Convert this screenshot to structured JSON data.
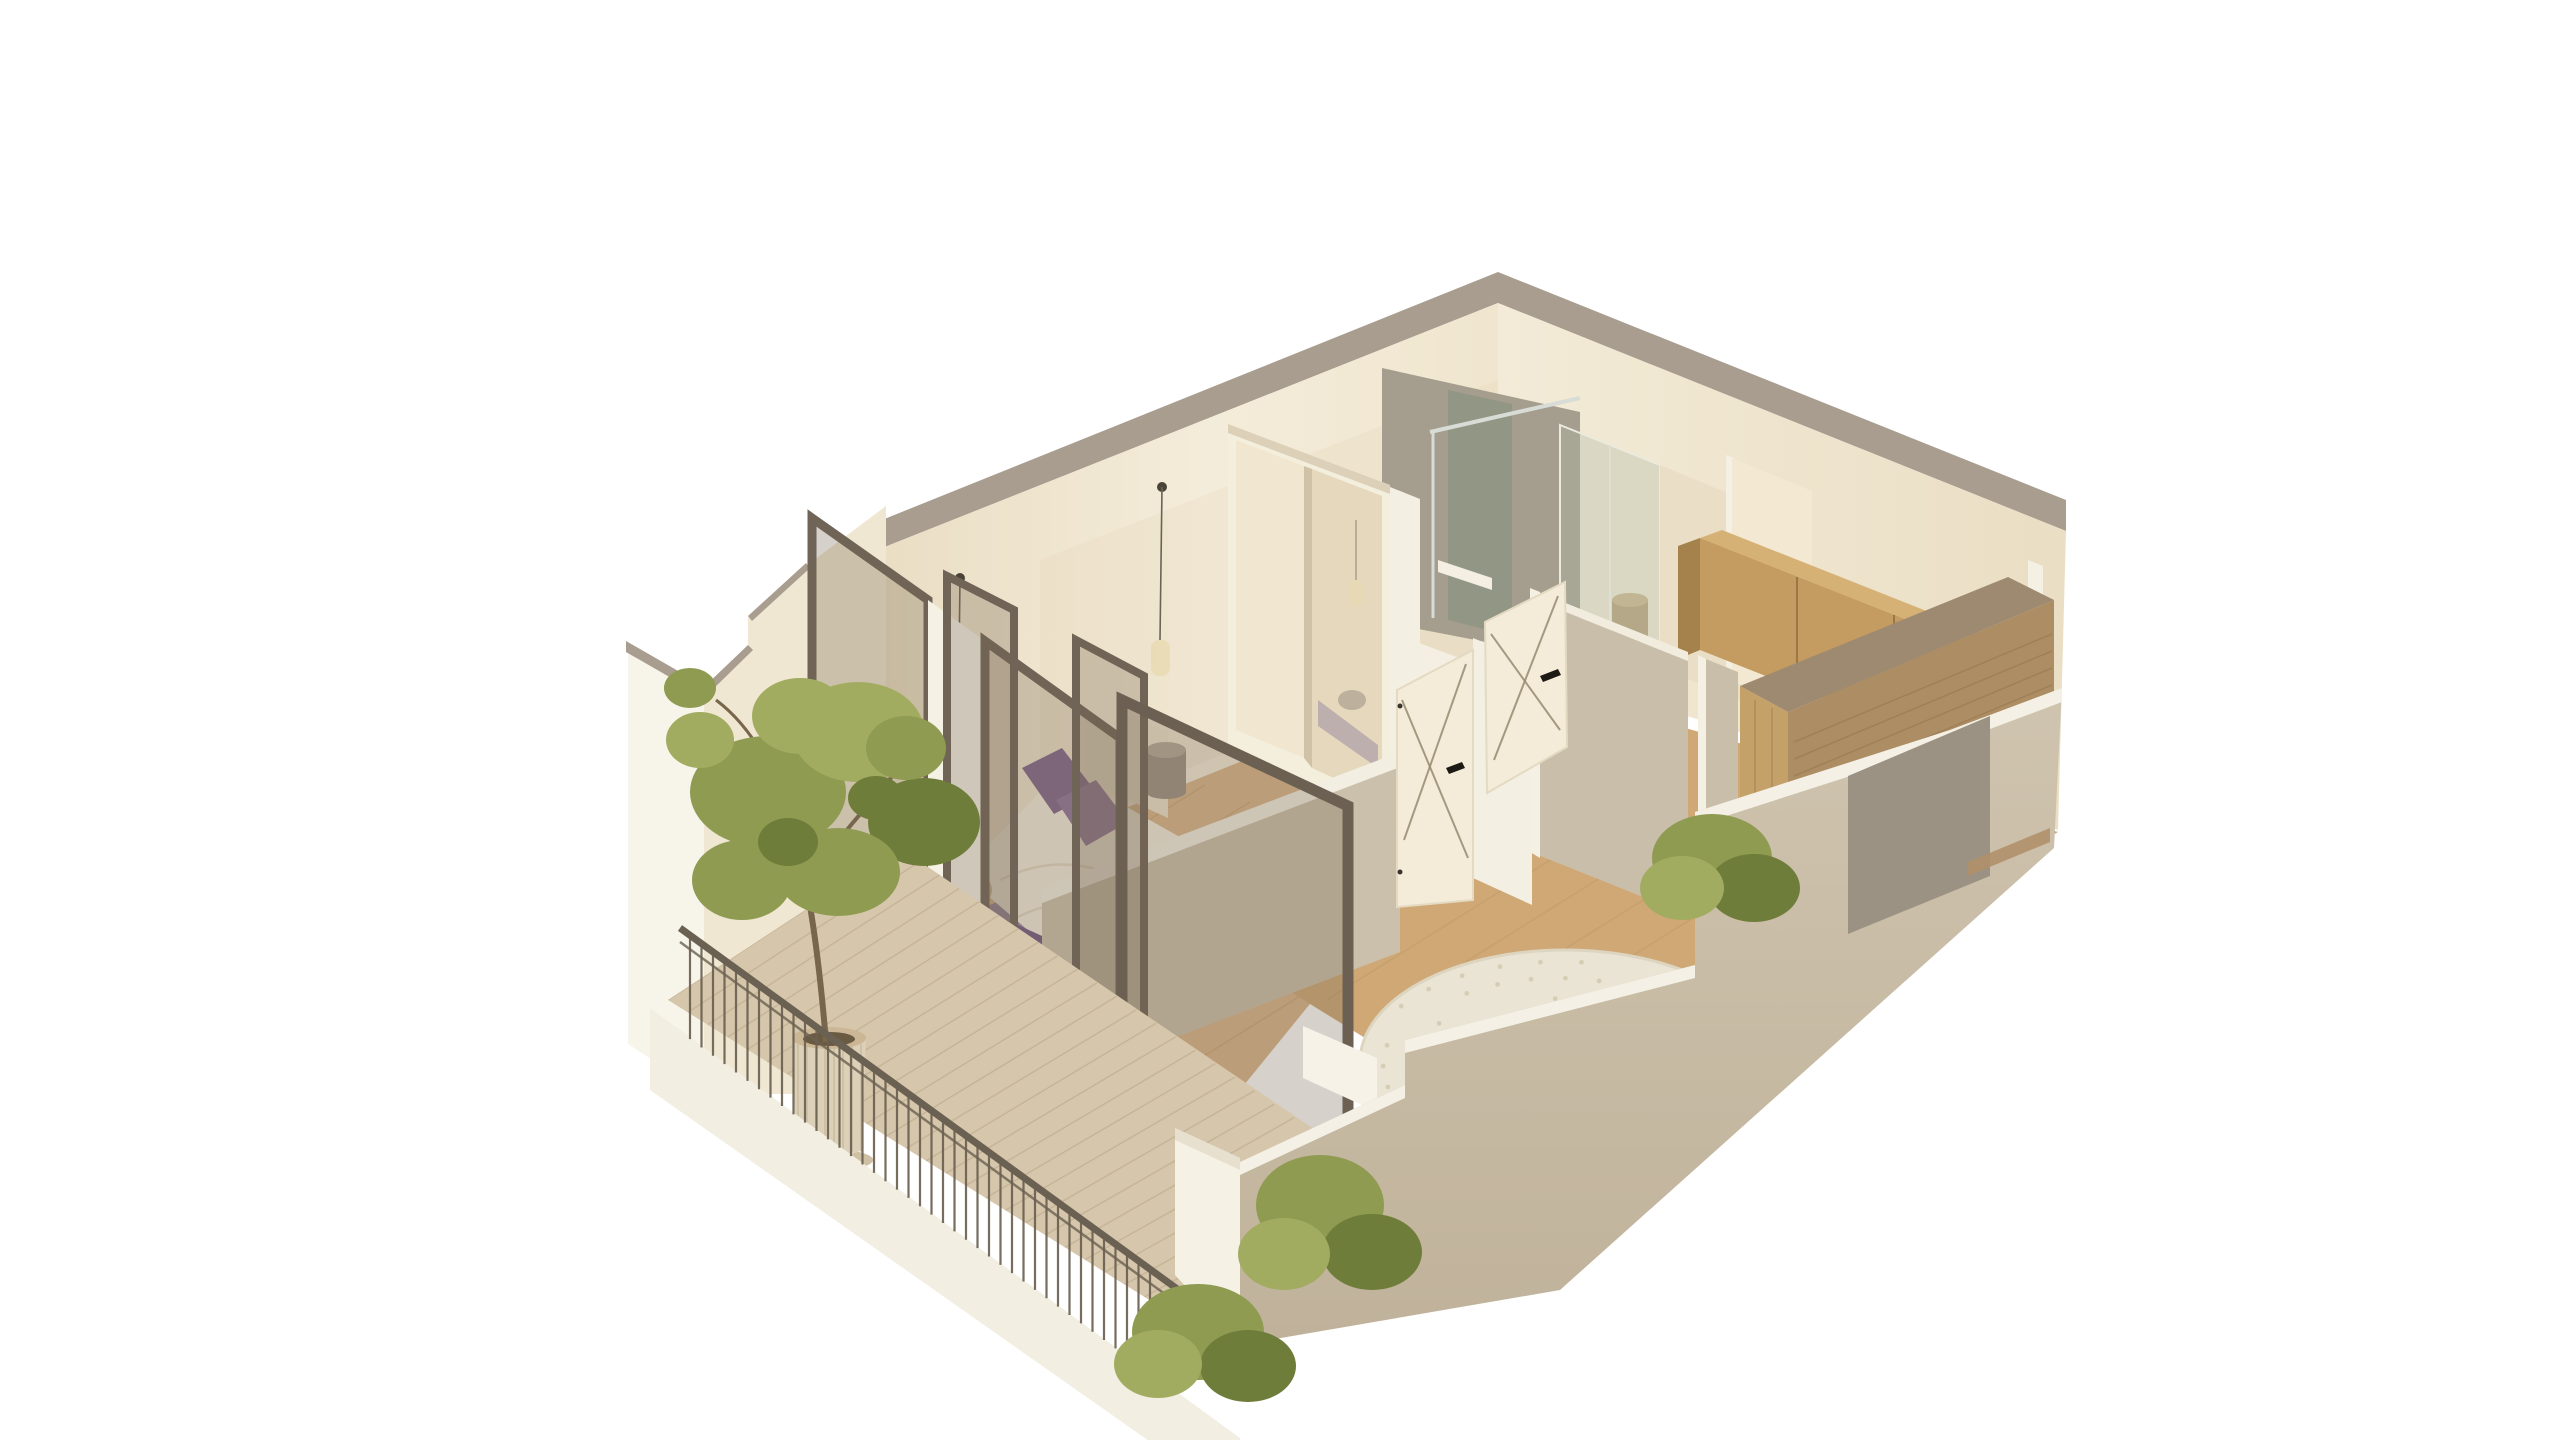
{
  "scene": {
    "kind": "architectural-3d-floorplan-render",
    "view": "isometric dollhouse cutaway, white background, no visible text",
    "rooms": [
      {
        "name": "bedroom",
        "contents": [
          "double bed with white duvet",
          "purple pillows",
          "purple throw",
          "purple rug",
          "cream headboard",
          "ribbed pouf side table",
          "wicker basket",
          "two glass pendant lights",
          "sliding-door wardrobe with mirror panel"
        ]
      },
      {
        "name": "bathroom",
        "contents": [
          "walk-in shower with glass screen",
          "chrome shower rail",
          "white shower tray",
          "purple bath mat",
          "tan pouf"
        ]
      },
      {
        "name": "hallway",
        "contents": [
          "two white open doors with cross-brace lines and black handles",
          "cut partition walls with white edges"
        ]
      },
      {
        "name": "living-kitchen",
        "contents": [
          "light wood upper cabinets",
          "wood counter peninsula with waterfall end",
          "round cream shaggy rug",
          "tall cream entry door",
          "green shrub"
        ]
      },
      {
        "name": "balcony",
        "contents": [
          "wood deck boards",
          "dark metal railing with vertical bars",
          "white parapet",
          "ribbed planter pot with tree",
          "green shrubs",
          "bronze-framed glass doors, two leaves open"
        ]
      }
    ]
  },
  "colors": {
    "background": "#ffffff",
    "wall_cut_top": "#a89d8f",
    "wall_cream_light": "#f4ecda",
    "wall_cream_dark": "#e7dcc2",
    "wall_cream_right1": "#f3ebd7",
    "wall_cream_right2": "#ebdfc5",
    "wall_white": "#f7f4ea",
    "wall_inner_cream": "#efe7d2",
    "wall_shade_overlay": "#dcc9a4",
    "partition_shadow": "#c9beaa",
    "partition_edge_white": "#f4f0e3",
    "partition_top_white": "#f1ecdd",
    "alcove_white": "#f3efe2",
    "low_wall_face": "#cbc0ab",
    "low_wall_top": "#f2eee1",
    "foreground_wall": "#cdc2ad",
    "foreground_wall_dark": "#c0b29a",
    "foreground_top_band": "#f4f0e5",
    "gray_door_panel": "#9c9283",
    "white_block": "#f5f1e5",
    "white_block_top": "#e7e0cf",
    "bench_white": "#f6f2e7",
    "wood_floor": "#cfa876",
    "wood_floor_light": "#d9b68a",
    "wood_seam": "#bf9a66",
    "bath_floor": "#e9ddc5",
    "shower_tray": "#f4efe2",
    "bathmat_purple": "#8a7796",
    "deck": "#d6c6ab",
    "deck_seam": "#bfae90",
    "parapet": "#f2eee1",
    "railing_metal": "#6b6152",
    "door_frame_bronze": "#6f6455",
    "door_frame_bronze_dark": "#6b6052",
    "glass_tint": "rgba(128,112,90,0.32)",
    "glass_tint_open": "rgba(120,104,82,0.30)",
    "shower_tile": "#a59d8d",
    "shower_glass_dark": "#8d9683",
    "shower_glass_front": "rgba(175,185,165,0.35)",
    "chrome": "#d8dcd6",
    "cabinet_wood": "#c49b60",
    "cabinet_wood_top": "#d6b176",
    "cabinet_wood_end": "#a5814c",
    "cabinet_seam": "#9a7744",
    "counter_top": "#9d8a71",
    "counter_face": "#ad8d64",
    "counter_waterfall": "#c4a169",
    "counter_grain": "#97784f",
    "wardrobe_frame": "#f4eedd",
    "wardrobe_panel": "#f1e7d0",
    "wardrobe_mirror": "#e5d8bd",
    "wardrobe_divider": "#cfc2a6",
    "wardrobe_top": "#dcd1b8",
    "door_white": "#f4ecd9",
    "door_edge": "#e4dac2",
    "door_brace_line": "rgba(150,138,112,0.85)",
    "door_handle_black": "#1d1a16",
    "entry_door": "#f3e9d2",
    "bed_duvet": "#f2ecdf",
    "bed_fold": "#e2d7c2",
    "bed_headboard": "#ece2cc",
    "pillow_purple": "#7d6189",
    "pillow_purple_light": "#8d7198",
    "throw_purple": "#6e5581",
    "rug_purple": "#8f7f9e",
    "round_rug": "#eae4d4",
    "round_rug_edge": "#ddd5c0",
    "round_rug_speckle": "#d6cdb5",
    "pouf_gray": "#9c9184",
    "pouf_gray_top": "#b3a897",
    "pouf_tan": "#b99f78",
    "pouf_tan_top": "#cbb28a",
    "basket": "#cdb493",
    "basket_line": "#b89c74",
    "pendant_cable": "#6a6255",
    "pendant_canopy": "#4a4438",
    "pendant_glass": "rgba(232,218,178,0.9)",
    "pendant_glass_edge": "#b5a67f",
    "foliage": "#8e9b51",
    "foliage_dark": "#6f7d3a",
    "foliage_light": "#a2ac61",
    "trunk": "#77664c",
    "pot": "#dcd0b8",
    "pot_rib": "#c6b89a",
    "pot_top": "#cbb795",
    "pot_soil": "#6b5a42",
    "pot_saucer": "#cfc0a4",
    "wood_sliver": "#b0906a"
  }
}
